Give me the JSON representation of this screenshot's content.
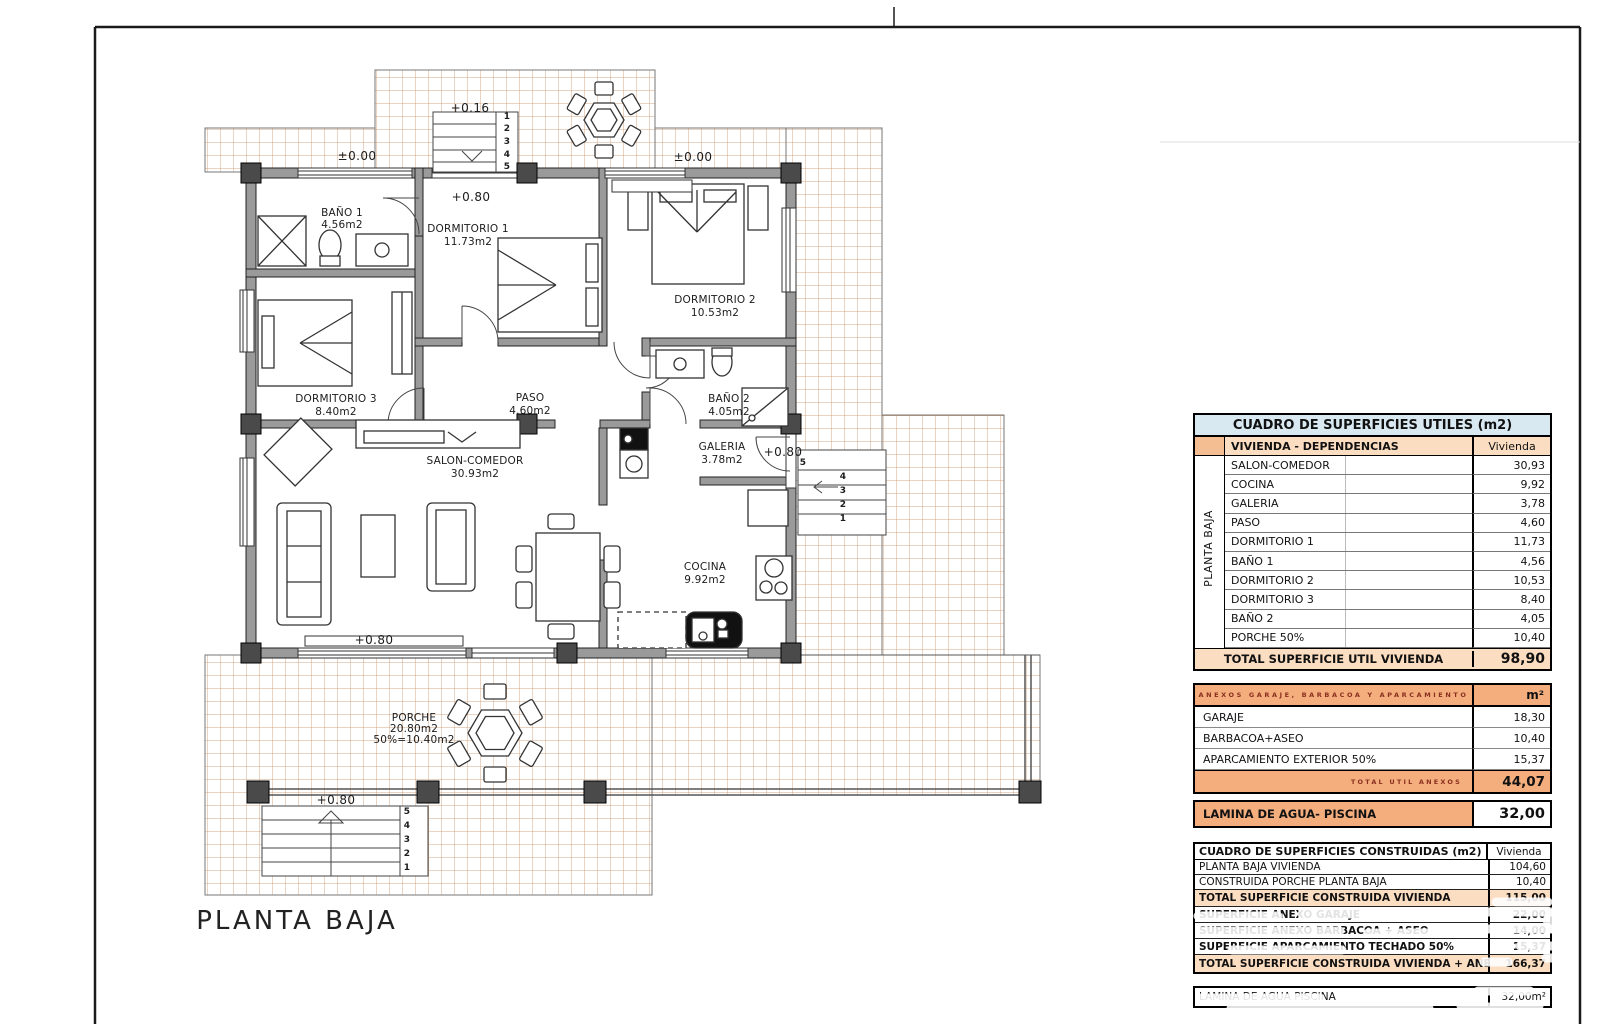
{
  "floor_plan": {
    "title": "PLANTA BAJA",
    "labels": [
      {
        "t": "BAÑO 1",
        "x": 342,
        "y": 213
      },
      {
        "t": "4.56m2",
        "x": 342,
        "y": 225
      },
      {
        "t": "DORMITORIO 1",
        "x": 468,
        "y": 229
      },
      {
        "t": "11.73m2",
        "x": 468,
        "y": 242
      },
      {
        "t": "DORMITORIO 2",
        "x": 715,
        "y": 300
      },
      {
        "t": "10.53m2",
        "x": 715,
        "y": 313
      },
      {
        "t": "DORMITORIO 3",
        "x": 336,
        "y": 399
      },
      {
        "t": "8.40m2",
        "x": 336,
        "y": 412
      },
      {
        "t": "PASO",
        "x": 530,
        "y": 398
      },
      {
        "t": "4.60m2",
        "x": 530,
        "y": 411
      },
      {
        "t": "BAÑO 2",
        "x": 729,
        "y": 399
      },
      {
        "t": "4.05m2",
        "x": 729,
        "y": 412
      },
      {
        "t": "SALON-COMEDOR",
        "x": 475,
        "y": 461
      },
      {
        "t": "30.93m2",
        "x": 475,
        "y": 474
      },
      {
        "t": "GALERIA",
        "x": 722,
        "y": 447
      },
      {
        "t": "3.78m2",
        "x": 722,
        "y": 460
      },
      {
        "t": "COCINA",
        "x": 705,
        "y": 567
      },
      {
        "t": "9.92m2",
        "x": 705,
        "y": 580
      },
      {
        "t": "PORCHE",
        "x": 414,
        "y": 718
      },
      {
        "t": "20.80m2",
        "x": 414,
        "y": 729
      },
      {
        "t": "50%=10.40m2",
        "x": 414,
        "y": 740
      },
      {
        "t": "±0.00",
        "cls": "lvl",
        "x": 357,
        "y": 156
      },
      {
        "t": "±0.00",
        "cls": "lvl",
        "x": 693,
        "y": 157
      },
      {
        "t": "+0.16",
        "cls": "lvl",
        "x": 470,
        "y": 108
      },
      {
        "t": "+0.80",
        "cls": "lvl",
        "x": 471,
        "y": 197
      },
      {
        "t": "+0.80",
        "cls": "lvl",
        "x": 783,
        "y": 452
      },
      {
        "t": "+0.80",
        "cls": "lvl",
        "x": 374,
        "y": 640
      },
      {
        "t": "+0.80",
        "cls": "lvl",
        "x": 336,
        "y": 800
      },
      {
        "t": "1",
        "cls": "num",
        "x": 507,
        "y": 117
      },
      {
        "t": "2",
        "cls": "num",
        "x": 507,
        "y": 129
      },
      {
        "t": "3",
        "cls": "num",
        "x": 507,
        "y": 142
      },
      {
        "t": "4",
        "cls": "num",
        "x": 507,
        "y": 155
      },
      {
        "t": "5",
        "cls": "num",
        "x": 507,
        "y": 167
      },
      {
        "t": "5",
        "cls": "num",
        "x": 803,
        "y": 463
      },
      {
        "t": "4",
        "cls": "num",
        "x": 843,
        "y": 477
      },
      {
        "t": "3",
        "cls": "num",
        "x": 843,
        "y": 491
      },
      {
        "t": "2",
        "cls": "num",
        "x": 843,
        "y": 505
      },
      {
        "t": "1",
        "cls": "num",
        "x": 843,
        "y": 519
      },
      {
        "t": "5",
        "cls": "num",
        "x": 407,
        "y": 812
      },
      {
        "t": "4",
        "cls": "num",
        "x": 407,
        "y": 826
      },
      {
        "t": "3",
        "cls": "num",
        "x": 407,
        "y": 840
      },
      {
        "t": "2",
        "cls": "num",
        "x": 407,
        "y": 854
      },
      {
        "t": "1",
        "cls": "num",
        "x": 407,
        "y": 868
      },
      {
        "t": "PLANTA BAJA",
        "cls": "title",
        "x": 297,
        "y": 921
      }
    ]
  },
  "tables": {
    "utiles": {
      "title": "CUADRO DE SUPERFICIES UTILES (m2)",
      "group_header": "VIVIENDA - DEPENDENCIAS",
      "col_header": "Vivienda",
      "side_label": "PLANTA BAJA",
      "rows": [
        {
          "label": "SALON-COMEDOR",
          "value": "30,93"
        },
        {
          "label": "COCINA",
          "value": "9,92"
        },
        {
          "label": "GALERIA",
          "value": "3,78"
        },
        {
          "label": "PASO",
          "value": "4,60"
        },
        {
          "label": "DORMITORIO 1",
          "value": "11,73"
        },
        {
          "label": "BAÑO 1",
          "value": "4,56"
        },
        {
          "label": "DORMITORIO 2",
          "value": "10,53"
        },
        {
          "label": "DORMITORIO 3",
          "value": "8,40"
        },
        {
          "label": "BAÑO 2",
          "value": "4,05"
        },
        {
          "label": "PORCHE 50%",
          "value": "10,40"
        }
      ],
      "total_label": "TOTAL SUPERFICIE UTIL VIVIENDA",
      "total_value": "98,90"
    },
    "anexos": {
      "header": "ANEXOS GARAJE, BARBACOA Y APARCAMIENTO",
      "unit": "m²",
      "rows": [
        {
          "label": "GARAJE",
          "value": "18,30"
        },
        {
          "label": "BARBACOA+ASEO",
          "value": "10,40"
        },
        {
          "label": "APARCAMIENTO EXTERIOR 50%",
          "value": "15,37"
        }
      ],
      "total_label": "TOTAL UTIL ANEXOS",
      "total_value": "44,07"
    },
    "lamina_agua": {
      "label": "LAMINA DE AGUA- PISCINA",
      "value": "32,00"
    },
    "construidas": {
      "title": "CUADRO DE SUPERFICIES CONSTRUIDAS (m2)",
      "col_header": "Vivienda",
      "rows": [
        {
          "label": "PLANTA BAJA VIVIENDA",
          "value": "104,60",
          "bold": false,
          "highlight": false
        },
        {
          "label": "CONSTRUIDA PORCHE PLANTA BAJA",
          "value": "10,40",
          "bold": false,
          "highlight": false
        },
        {
          "label": "TOTAL SUPERFICIE CONSTRUIDA VIVIENDA",
          "value": "115,00",
          "bold": true,
          "highlight": true
        },
        {
          "label": "SUPERFICIE ANEXO GARAJE",
          "value": "22,00",
          "bold": true,
          "highlight": false
        },
        {
          "label": "SUPERFICIE ANEXO BARBACOA + ASEO",
          "value": "14,00",
          "bold": true,
          "highlight": false
        },
        {
          "label": "SUPERFICIE APARCAMIENTO TECHADO 50%",
          "value": "15,37",
          "bold": true,
          "highlight": false
        },
        {
          "label": "TOTAL SUPERFICIE CONSTRUIDA VIVIENDA + ANEXOS",
          "value": "166,37",
          "bold": true,
          "highlight": true
        }
      ]
    },
    "lamina_agua2": {
      "label": "LAMINA DE AGUA PISCINA",
      "value": "32,00m²"
    }
  }
}
